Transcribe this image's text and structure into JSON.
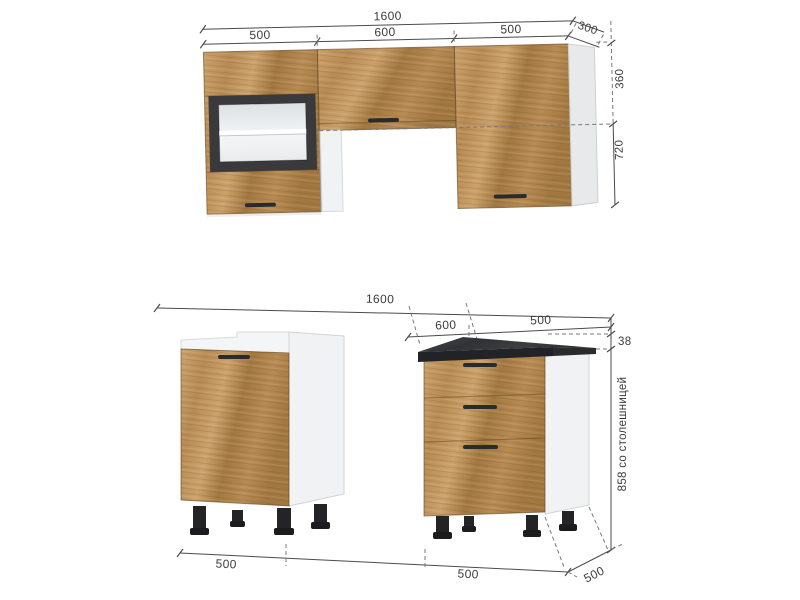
{
  "colors": {
    "wood_light": "#cba26c",
    "wood_base": "#b78b53",
    "wood_dark": "#a27841",
    "carcass": "#f1f2f3",
    "panel_edge": "#d2d4d5",
    "frame": "#3a3a3c",
    "glass": "#e4e8ea",
    "shelf": "#ffffff",
    "countertop": "#3b3c3e",
    "countertop_edge": "#222326",
    "handle": "#2b2b2d",
    "leg": "#242426",
    "dim_line": "#4b4b4d",
    "dash": "#77787a",
    "text": "#3b3b3d",
    "background": "#ffffff"
  },
  "upper_section": {
    "dim_total_width": "1600",
    "dim_widths": [
      "500",
      "600",
      "500"
    ],
    "dim_depth": "300",
    "dim_upper_cabinet_height": "360",
    "dim_total_height": "720"
  },
  "lower_section": {
    "dim_total_width": "1600",
    "dim_gap_width": "600",
    "dim_right_cabinet_width": "500",
    "dim_countertop_thickness": "38",
    "dim_height_with_countertop": "858 со столешницей",
    "dim_left_cabinet_width": "500",
    "dim_right_cabinet_width_bottom": "500",
    "dim_depth": "500"
  }
}
